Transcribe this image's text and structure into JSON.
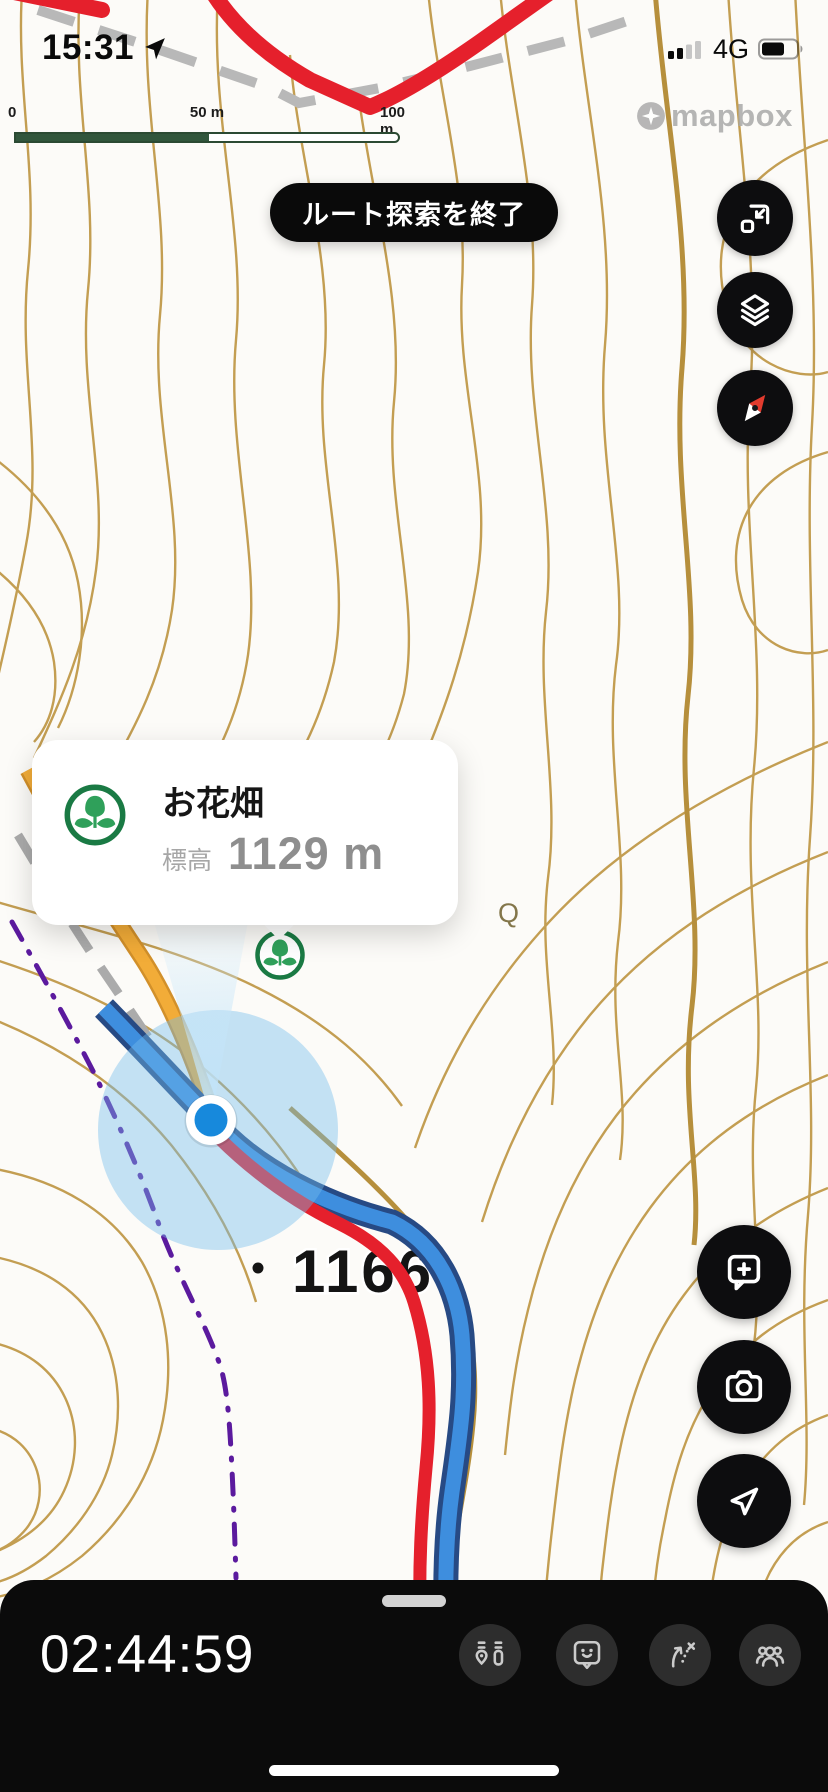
{
  "status_bar": {
    "time": "15:31",
    "network": "4G",
    "signal_bars_filled": 2,
    "signal_bars_total": 4,
    "battery_fraction": 0.62
  },
  "scale_bar": {
    "labels": [
      "0",
      "50 m",
      "100 m"
    ]
  },
  "map": {
    "attribution": "mapbox",
    "spot_elevation": "1166",
    "vegetation_symbol": "Q",
    "colors": {
      "contour": "#c39e52",
      "index_contour": "#b68f3c",
      "planned_route": "#e5202c",
      "recorded_track": "#3e8ede",
      "track_casing": "#274a84",
      "road": "#eda832",
      "boundary": "#5b1a9e",
      "dashed_trail": "#b8b8b8",
      "accuracy_circle": "#74bdec",
      "location_dot": "#1789dc",
      "marker_green": "#1a7a44"
    }
  },
  "route_banner": {
    "label": "ルート探索を終了"
  },
  "poi_card": {
    "title": "お花畑",
    "elevation_label": "標高",
    "elevation_value": "1129 m"
  },
  "map_controls": {
    "items": [
      {
        "name": "collapse-map"
      },
      {
        "name": "layers"
      },
      {
        "name": "compass"
      }
    ]
  },
  "action_buttons": {
    "items": [
      {
        "name": "add-memo"
      },
      {
        "name": "camera"
      },
      {
        "name": "share-location"
      }
    ]
  },
  "bottom_bar": {
    "timer": "02:44:59",
    "buttons": [
      {
        "name": "activity-stats"
      },
      {
        "name": "memo-reactions"
      },
      {
        "name": "route-exit"
      },
      {
        "name": "group-members"
      }
    ]
  }
}
